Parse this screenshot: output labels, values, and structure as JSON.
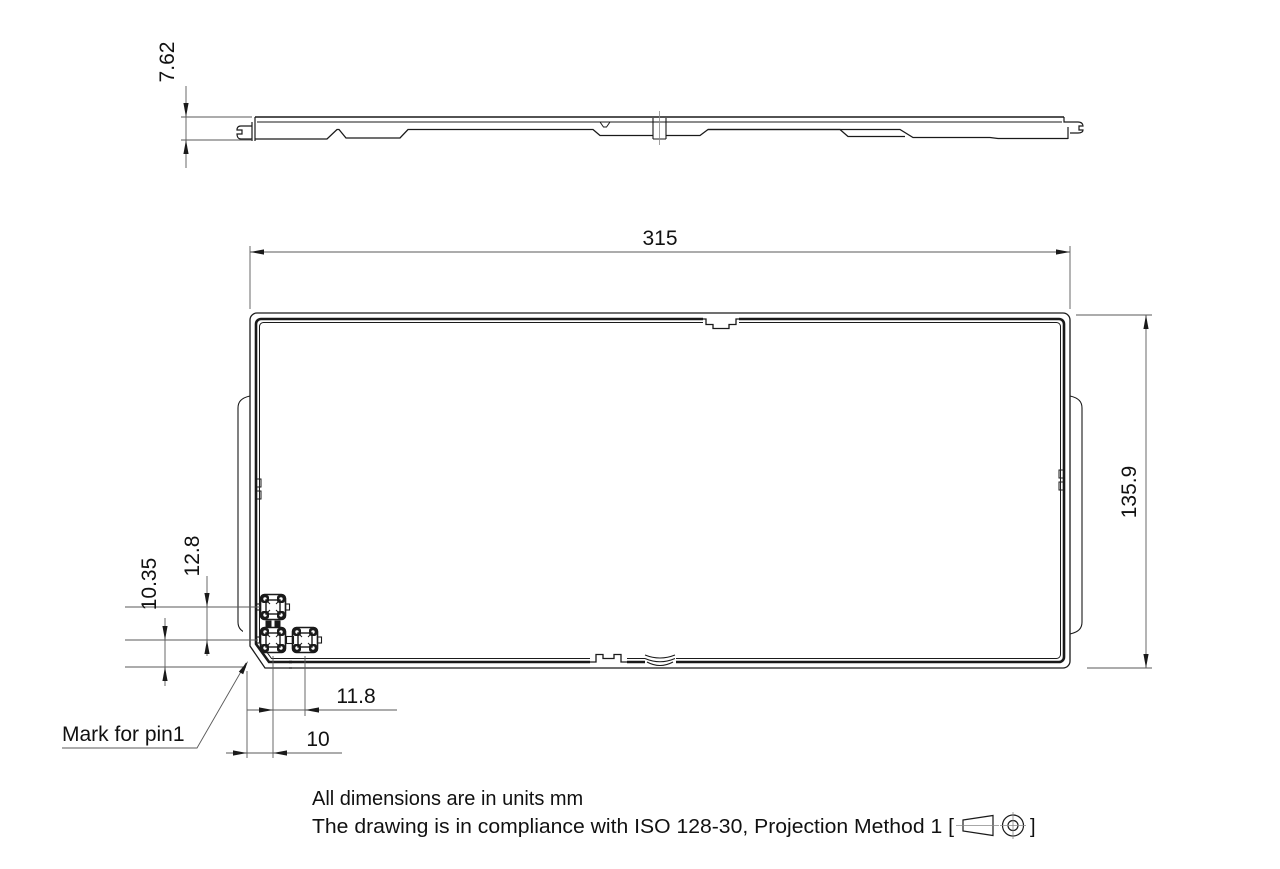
{
  "drawing": {
    "colors": {
      "background": "#ffffff",
      "line": "#1a1a1a",
      "dim_line": "#5a5a5a"
    },
    "dimensions": {
      "thickness_mm": "7.62",
      "overall_width_mm": "315",
      "overall_height_mm": "135.9",
      "pin_bottom_offset_mm": "10.35",
      "pin_vertical_pitch_mm": "12.8",
      "pin_horizontal_pitch_mm": "11.8",
      "pin_left_offset_mm": "10"
    },
    "callouts": {
      "pin1_mark": "Mark for pin1"
    },
    "notes": {
      "units_line": "All dimensions are in units mm",
      "compliance_prefix": "The drawing is in compliance with ISO 128-30, Projection Method 1 [",
      "compliance_suffix": "]"
    }
  }
}
